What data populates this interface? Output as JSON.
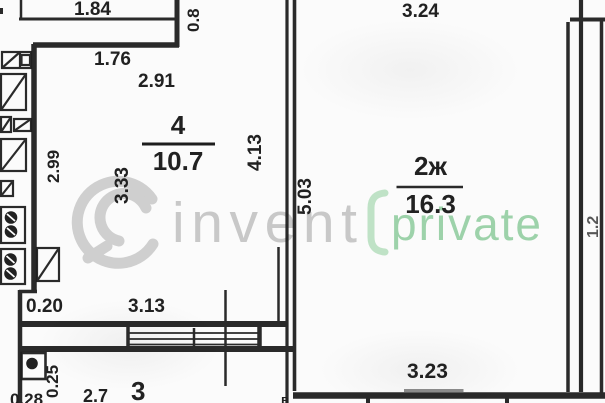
{
  "document": {
    "kind": "apartment floor plan (BTI style scan)"
  },
  "watermark": {
    "logo": "swirl-logo",
    "text_gray": "invent",
    "text_green": "private",
    "color_gray": "#c6c6c6",
    "color_green": "#9dd2aa"
  },
  "rooms": {
    "room4": {
      "number": "4",
      "area": "10.7"
    },
    "room2zh": {
      "number": "2ж",
      "area": "16.3"
    },
    "room3": {
      "number": "3"
    }
  },
  "dimensions": {
    "balcony_width": "1.84",
    "balcony_depth": "0.8",
    "window_176": "1.76",
    "room4_width": "2.91",
    "wall_left_299": "2.99",
    "room4_height_333": "3.33",
    "wall_413": "4.13",
    "room2zh_height_503": "5.03",
    "room2zh_width_top": "3.24",
    "room2zh_width_bottom": "3.23",
    "niche_020": "0.20",
    "room4_bottom_313": "3.13",
    "room3_left_025": "0.25",
    "cut_bottom_left": "0.28",
    "cut_room3_height": "2.7",
    "cut_right_edge": "1.2",
    "cut_wall_letter": "в"
  },
  "colors": {
    "line": "#1d1d1d",
    "underline_gray": "#8a8a8a",
    "background": "#fbfbfb"
  }
}
